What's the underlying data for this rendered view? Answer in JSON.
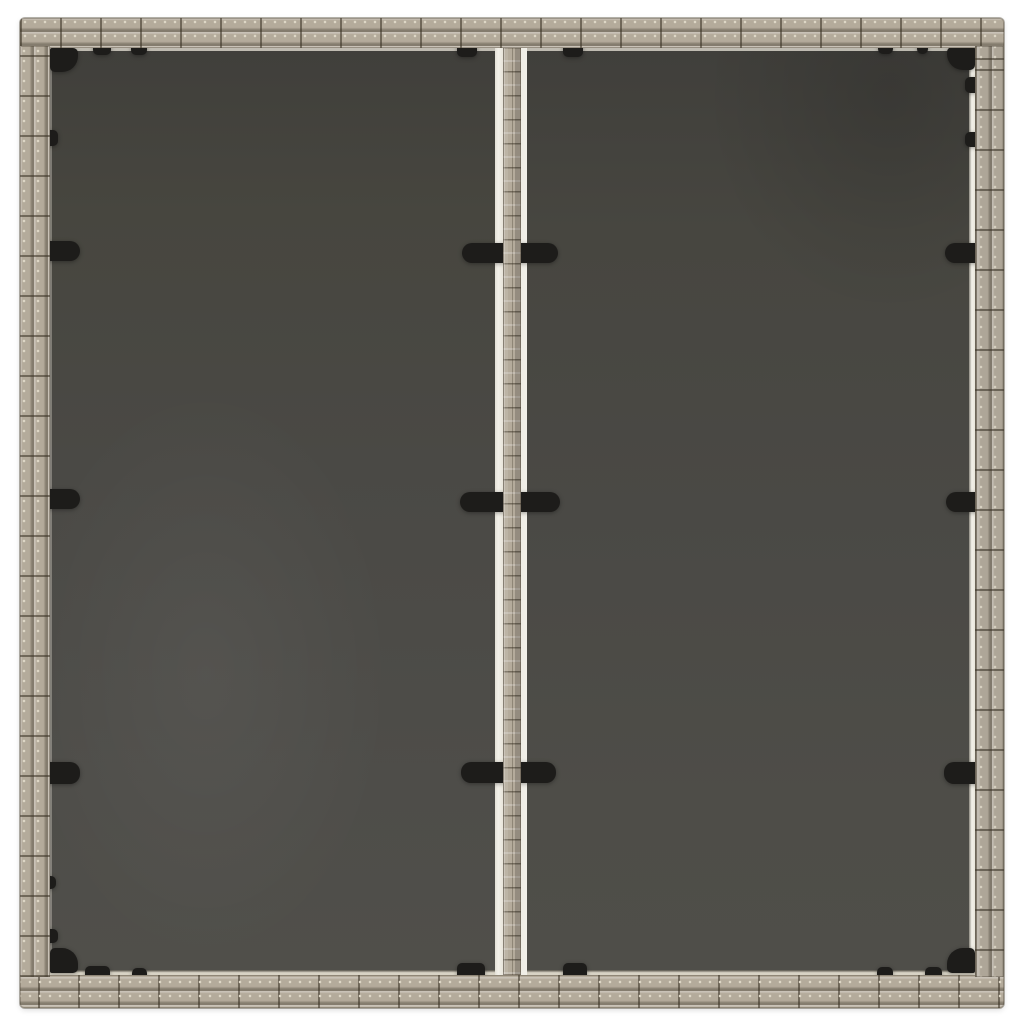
{
  "scene": {
    "description": "Top-down product photograph of a square gray poly-rattan garden table with a two-panel dark glass tabletop, a woven rattan divider strip down the middle, and black glass retaining clips, on a plain white background",
    "background_color": "#ffffff"
  },
  "table": {
    "frame": {
      "material": "poly rattan weave",
      "color": "#b4ab9b",
      "highlight": "#d6cfc0",
      "shadow": "#6e6452",
      "weave_line_color": "#4e4636"
    },
    "glass": {
      "panel_count": 2,
      "color": "#4a4945",
      "dark_shade": "#403f3b",
      "light_shade": "#504f4a",
      "edge_reflection_color": "#f2f0e9"
    },
    "divider": {
      "strip_color": "#b4ab9b",
      "edge_reflection_color": "#f2f0e9"
    },
    "clips": {
      "color": "#1d1c1a",
      "corner_clips": 4,
      "edge_pill_clips": 6,
      "divider_pill_clips": 6,
      "small_tabs": 17
    }
  },
  "colors": {
    "bg": "#ffffff",
    "frame": "#b4ab9b",
    "frame-hi": "#d6cfc0",
    "weave-line": "#4e4636",
    "stitch": "#ddd6c5",
    "glass": "#4a4945",
    "glass-dark": "#403f3b",
    "glass-light": "#504f4a",
    "edge": "#f2f0e9",
    "edge-dim": "#d8d3c5",
    "clip": "#1d1c1a"
  }
}
